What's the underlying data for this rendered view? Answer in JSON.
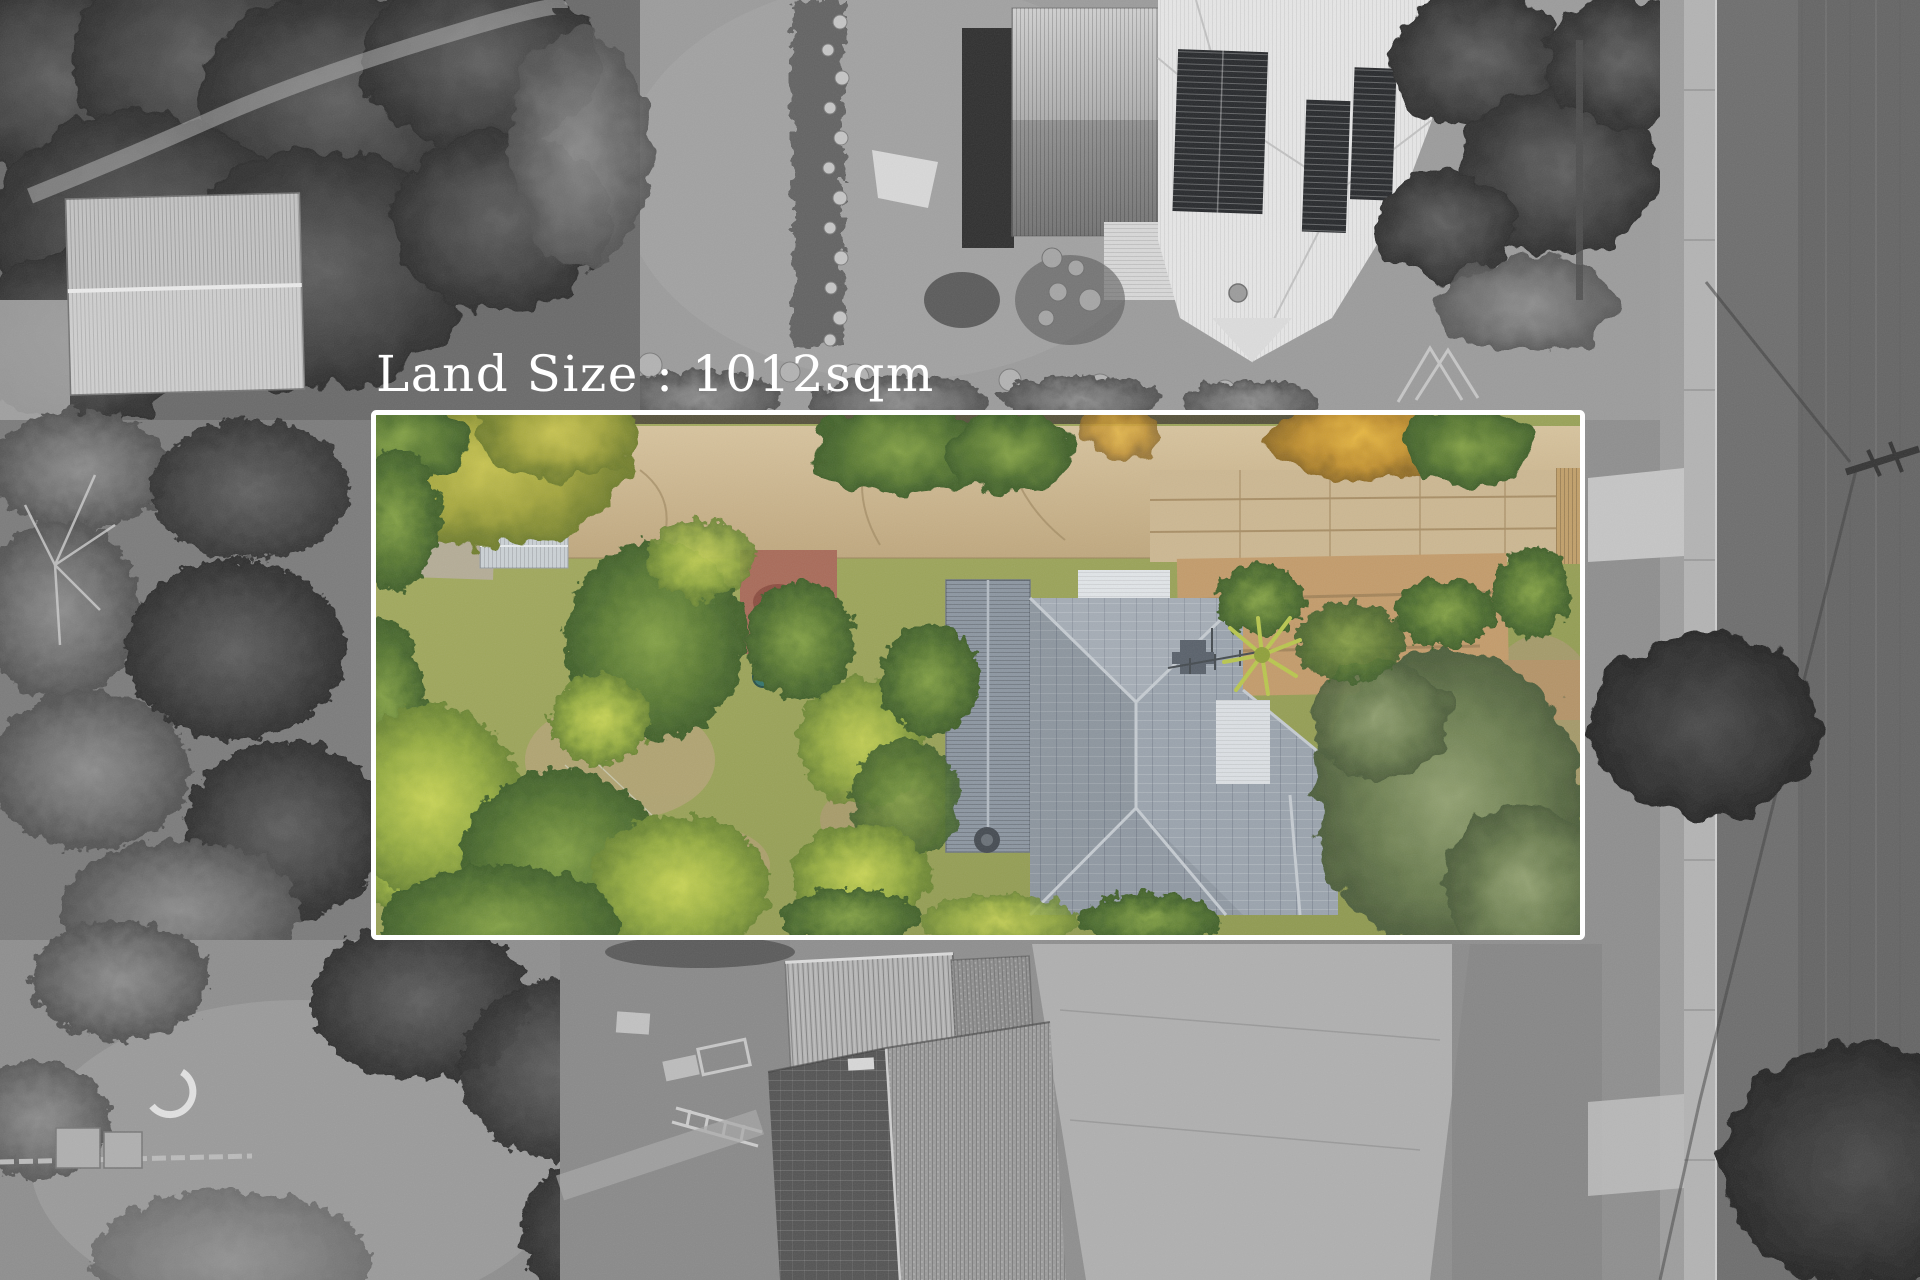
{
  "annotation": {
    "land_size_label": "Land Size : 1012sqm",
    "land_size_value": "1012",
    "land_size_unit": "sqm",
    "text_color": "#ffffff"
  },
  "boundary": {
    "shape": "rectangle",
    "stroke_color": "#ffffff"
  },
  "palette": {
    "monochrome_surround": "#8f8f8f",
    "road_asphalt": "#6e6e6e",
    "sidewalk": "#b4b4b4",
    "white_roof": "#e7e7e7",
    "solar_panel": "#27292c",
    "property_lawn": "#9aa45a",
    "property_driveway": "#cdb48c",
    "house_roof_gray": "#9ba4ae",
    "foliage_green": "#5d7c33",
    "foliage_gold": "#c49231",
    "olive_tree": "#6e8052",
    "mulch_brown": "#c49c6b",
    "patio_red": "#a96b59"
  }
}
